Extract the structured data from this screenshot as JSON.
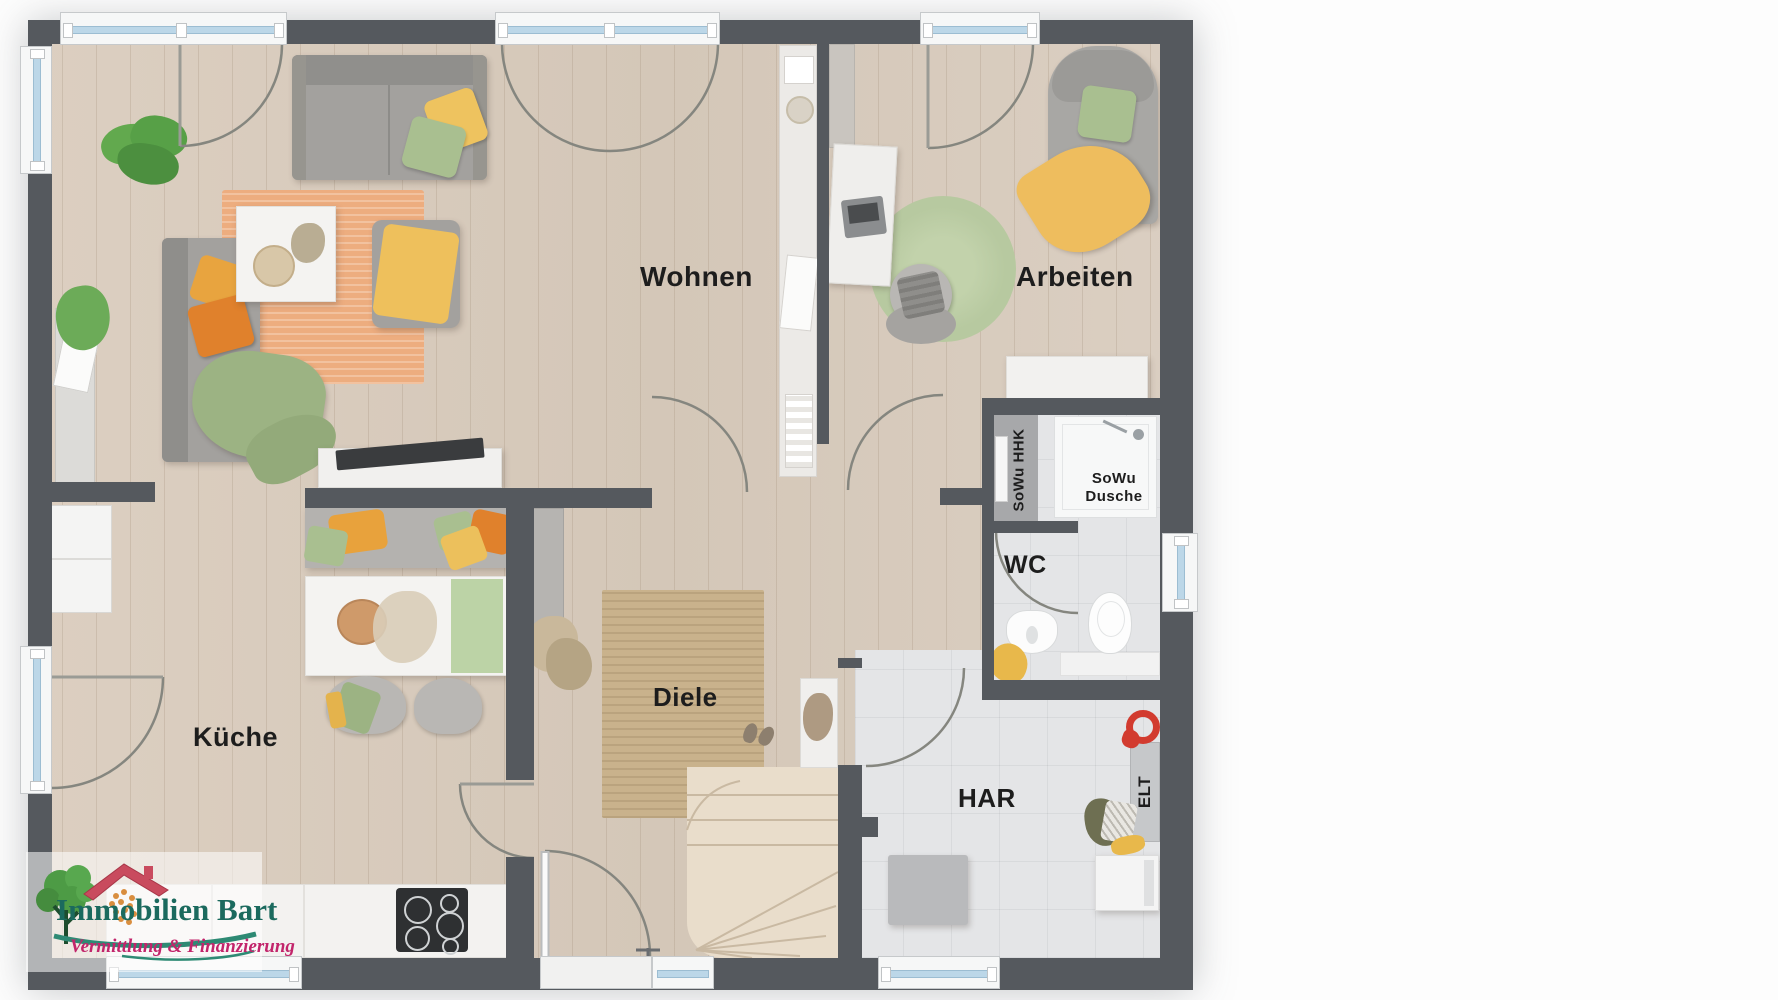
{
  "document": {
    "type": "floor-plan",
    "style": "3d-top-down-rendering"
  },
  "rooms": {
    "living": "Wohnen",
    "office": "Arbeiten",
    "kitchen": "Küche",
    "hallway": "Diele",
    "toilet": "WC",
    "utility": "HAR"
  },
  "annotations": {
    "electrical": "ELT",
    "water_heater": "SoWu HHK",
    "shower": "SoWu Dusche"
  },
  "logo": {
    "brand": "Immobilien Bart",
    "tagline": "Vermittlung & Finanzierung"
  },
  "colors": {
    "wall": "#55595e",
    "wood_floor": "#d8ccbe",
    "tile_floor": "#e4e5e7",
    "window_glass": "#bcd7e8",
    "rug_living": "#edad7f",
    "rug_hall_jute": "#c9b28c",
    "rug_office_green": "#b7c9a0",
    "sofa_gray": "#a3a19e",
    "pillow_yellow": "#eebd5e",
    "pillow_green": "#a9bf90",
    "pillow_orange": "#e0812c",
    "stair_wood": "#e9ddcb",
    "label_ink": "#1d1d1d",
    "logo_teal": "#1b6a5e",
    "logo_pink": "#c2256b",
    "logo_roof_red": "#c94b5e",
    "logo_tree_green": "#4d9b45"
  }
}
